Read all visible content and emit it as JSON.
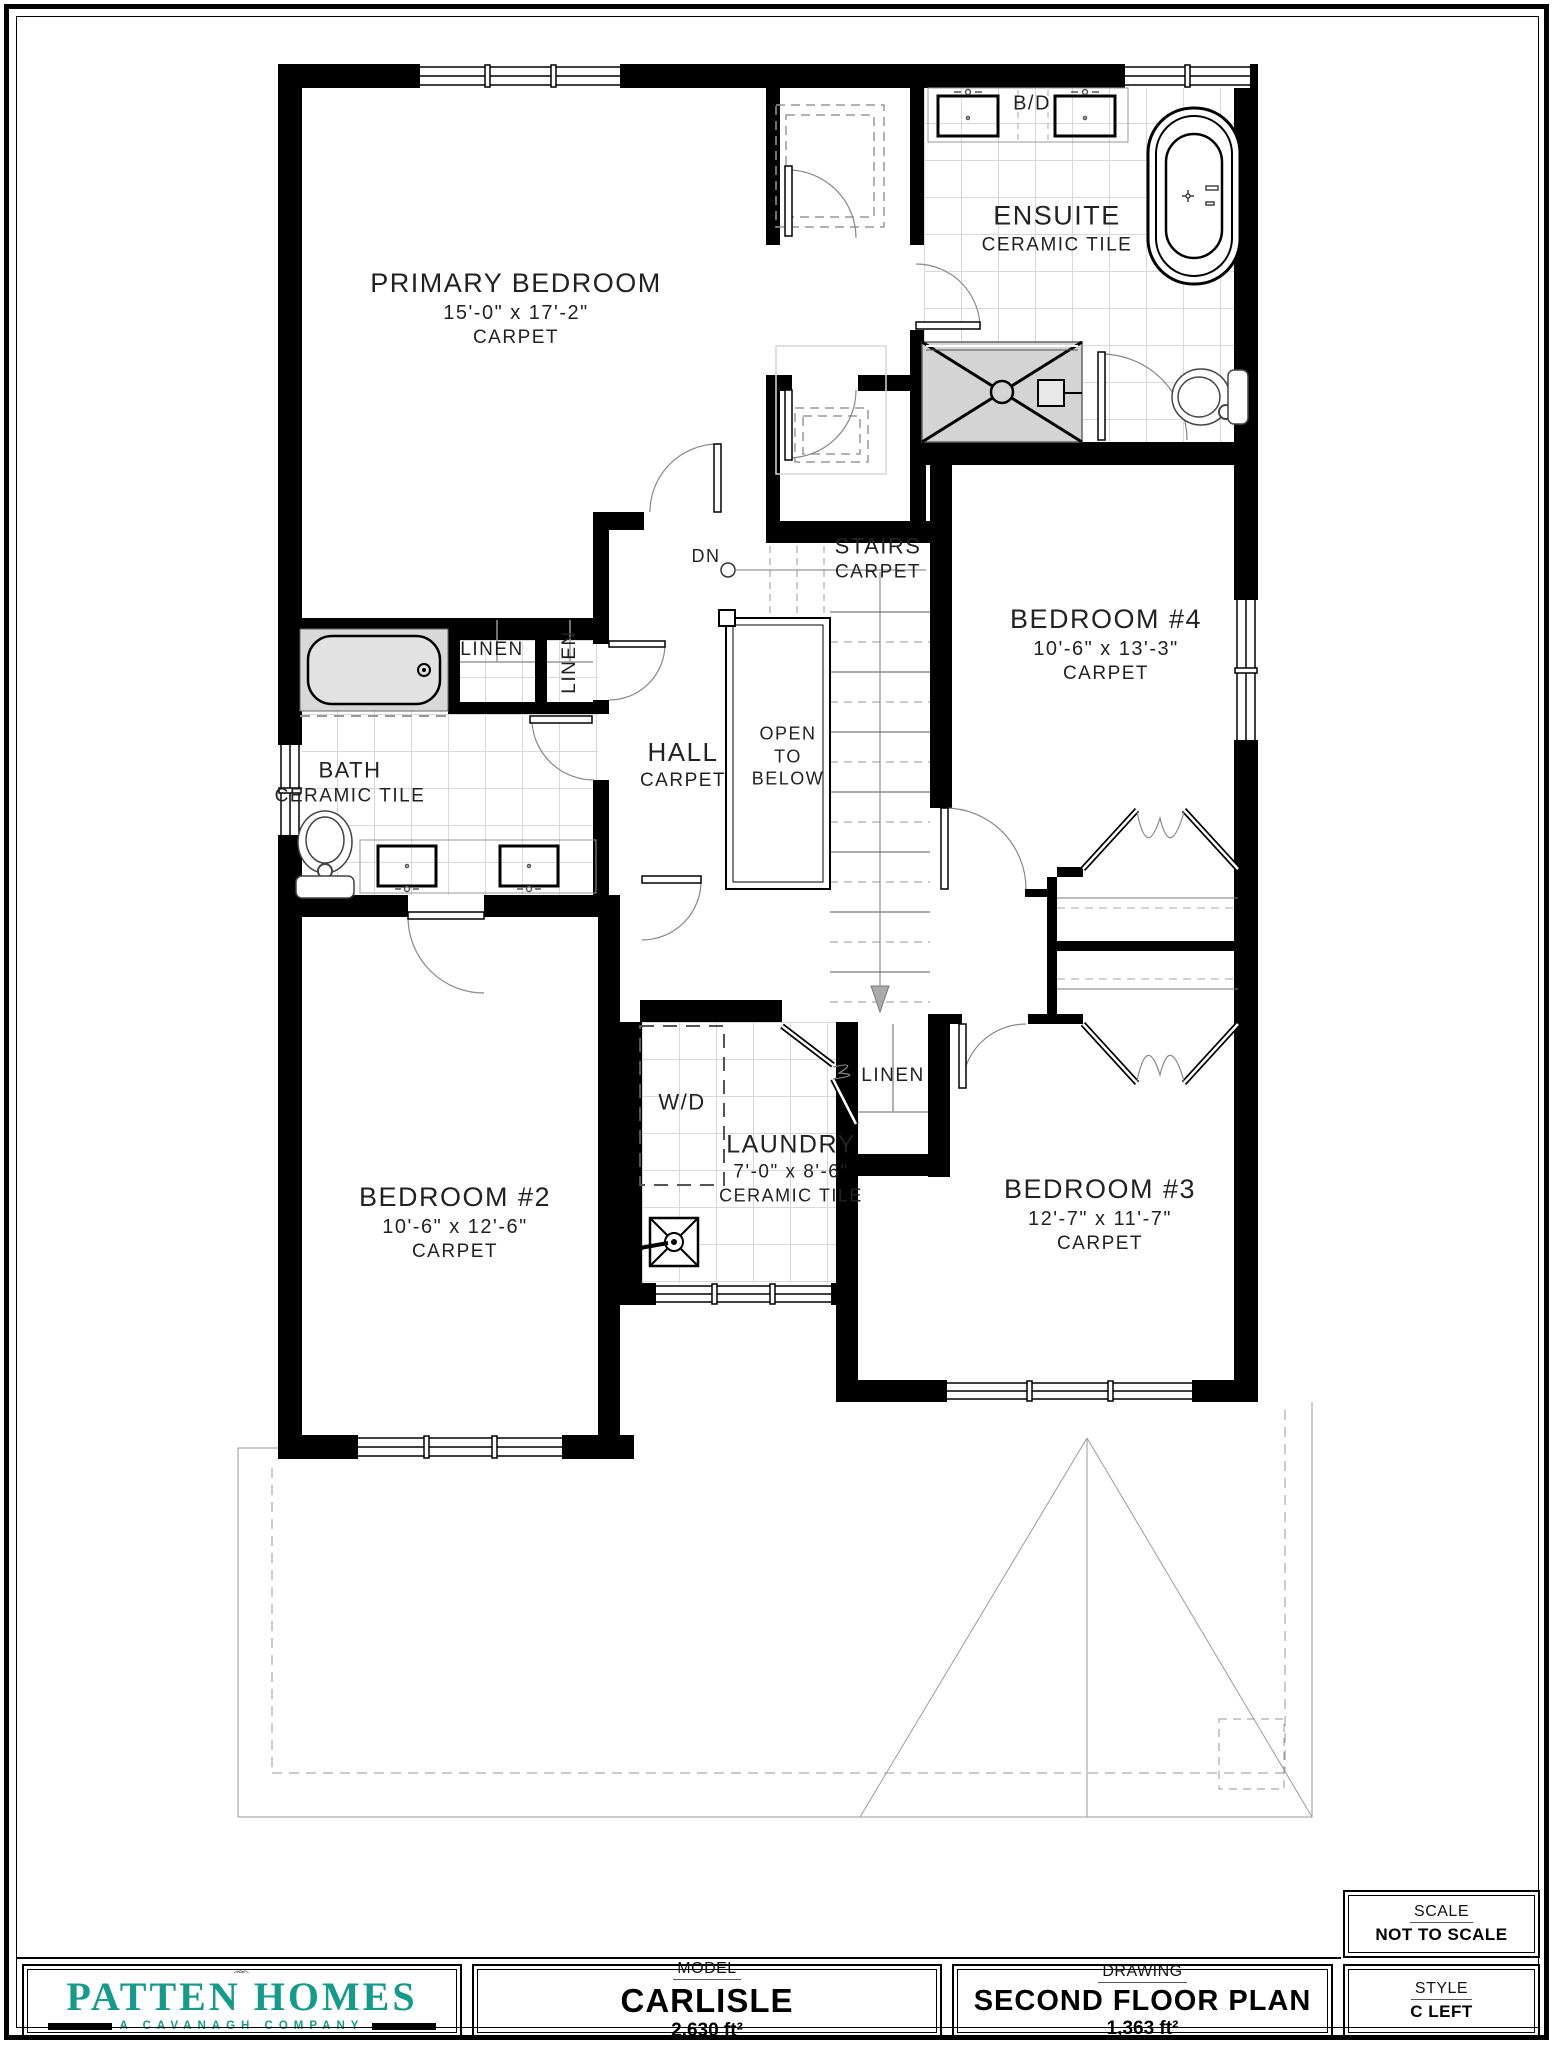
{
  "plan": {
    "rooms": {
      "primary": {
        "name": "PRIMARY BEDROOM",
        "dims": "15'-0\" x 17'-2\"",
        "floor": "CARPET"
      },
      "ensuite": {
        "name": "ENSUITE",
        "floor": "CERAMIC TILE"
      },
      "bedroom4": {
        "name": "BEDROOM #4",
        "dims": "10'-6\" x 13'-3\"",
        "floor": "CARPET"
      },
      "stairs": {
        "name": "STAIRS",
        "floor": "CARPET"
      },
      "hall": {
        "name": "HALL",
        "floor": "CARPET"
      },
      "bath": {
        "name": "BATH",
        "floor": "CERAMIC TILE"
      },
      "laundry": {
        "name": "LAUNDRY",
        "dims": "7'-0\" x 8'-6\"",
        "floor": "CERAMIC TILE"
      },
      "bedroom2": {
        "name": "BEDROOM #2",
        "dims": "10'-6\" x 12'-6\"",
        "floor": "CARPET"
      },
      "bedroom3": {
        "name": "BEDROOM #3",
        "dims": "12'-7\" x 11'-7\"",
        "floor": "CARPET"
      }
    },
    "labels": {
      "dn": "DN",
      "wd": "W/D",
      "bd": "B/D",
      "linen": "LINEN",
      "open_1": "OPEN",
      "open_2": "TO",
      "open_3": "BELOW"
    }
  },
  "title_block": {
    "brand": {
      "name": "PATTEN HOMES",
      "tagline": "A CAVANAGH COMPANY"
    },
    "model": {
      "heading": "MODEL",
      "value": "CARLISLE",
      "area": "2,630 ft²"
    },
    "drawing": {
      "heading": "DRAWING",
      "value": "SECOND FLOOR PLAN",
      "area": "1,363 ft²"
    },
    "scale": {
      "heading": "SCALE",
      "value": "NOT TO SCALE"
    },
    "style": {
      "heading": "STYLE",
      "value": "C LEFT"
    }
  },
  "colors": {
    "teal": "#189a8a",
    "wall": "#000000",
    "fixture_gray": "#d8d8d8"
  }
}
